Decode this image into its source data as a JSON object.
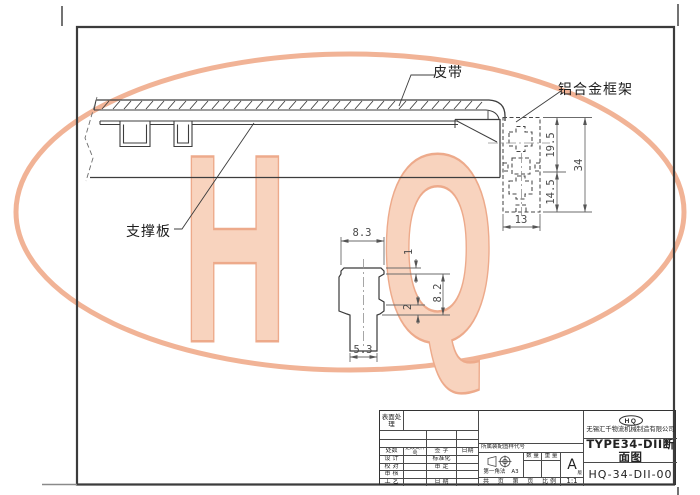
{
  "watermark": {
    "letter_h": "H",
    "letter_q": "Q",
    "ellipse_color": "#f1b396",
    "letter_fill": "#f8d3be",
    "letter_outline": "#edaa8b"
  },
  "annotations": {
    "belt": "皮带",
    "aluminum_frame": "铝合金框架",
    "support_plate": "支撑板"
  },
  "dimensions": {
    "profile_upper_height": "19.5",
    "profile_lower_height": "14.5",
    "profile_total_height": "34",
    "profile_width": "13",
    "detail_top_width": "8.3",
    "detail_top_thickness": "1",
    "detail_height": "8.2",
    "detail_lip": "2",
    "detail_stem_width": "5.3"
  },
  "title_block": {
    "surface_treatment": "表面处理",
    "rev_header": {
      "count": "处数",
      "doc_no": "更改文件号",
      "sign": "签 字",
      "date": "日期"
    },
    "roles": {
      "design": "设 计",
      "check": "校 对",
      "review": "审 核",
      "process": "工 艺",
      "standard": "标准化",
      "approve": "审 定",
      "date": "日 期"
    },
    "belongs_label": "所属装配图样代号",
    "projection_label": "第一角法",
    "paper_size": "A3",
    "qty_label": "数 量",
    "weight_label": "重 量",
    "rev_letter": "A",
    "rev_suffix": "版",
    "sheet_row": {
      "total": "共",
      "page1": "页",
      "no": "第",
      "page2": "页",
      "scale_label": "比 例",
      "scale_value": "1:1"
    },
    "logo": "HQ",
    "company": "无锡汇千物流机械制造有限公司",
    "drawing_title": "TYPE34-DII断面图",
    "drawing_number": "HQ-34-DII-00"
  }
}
